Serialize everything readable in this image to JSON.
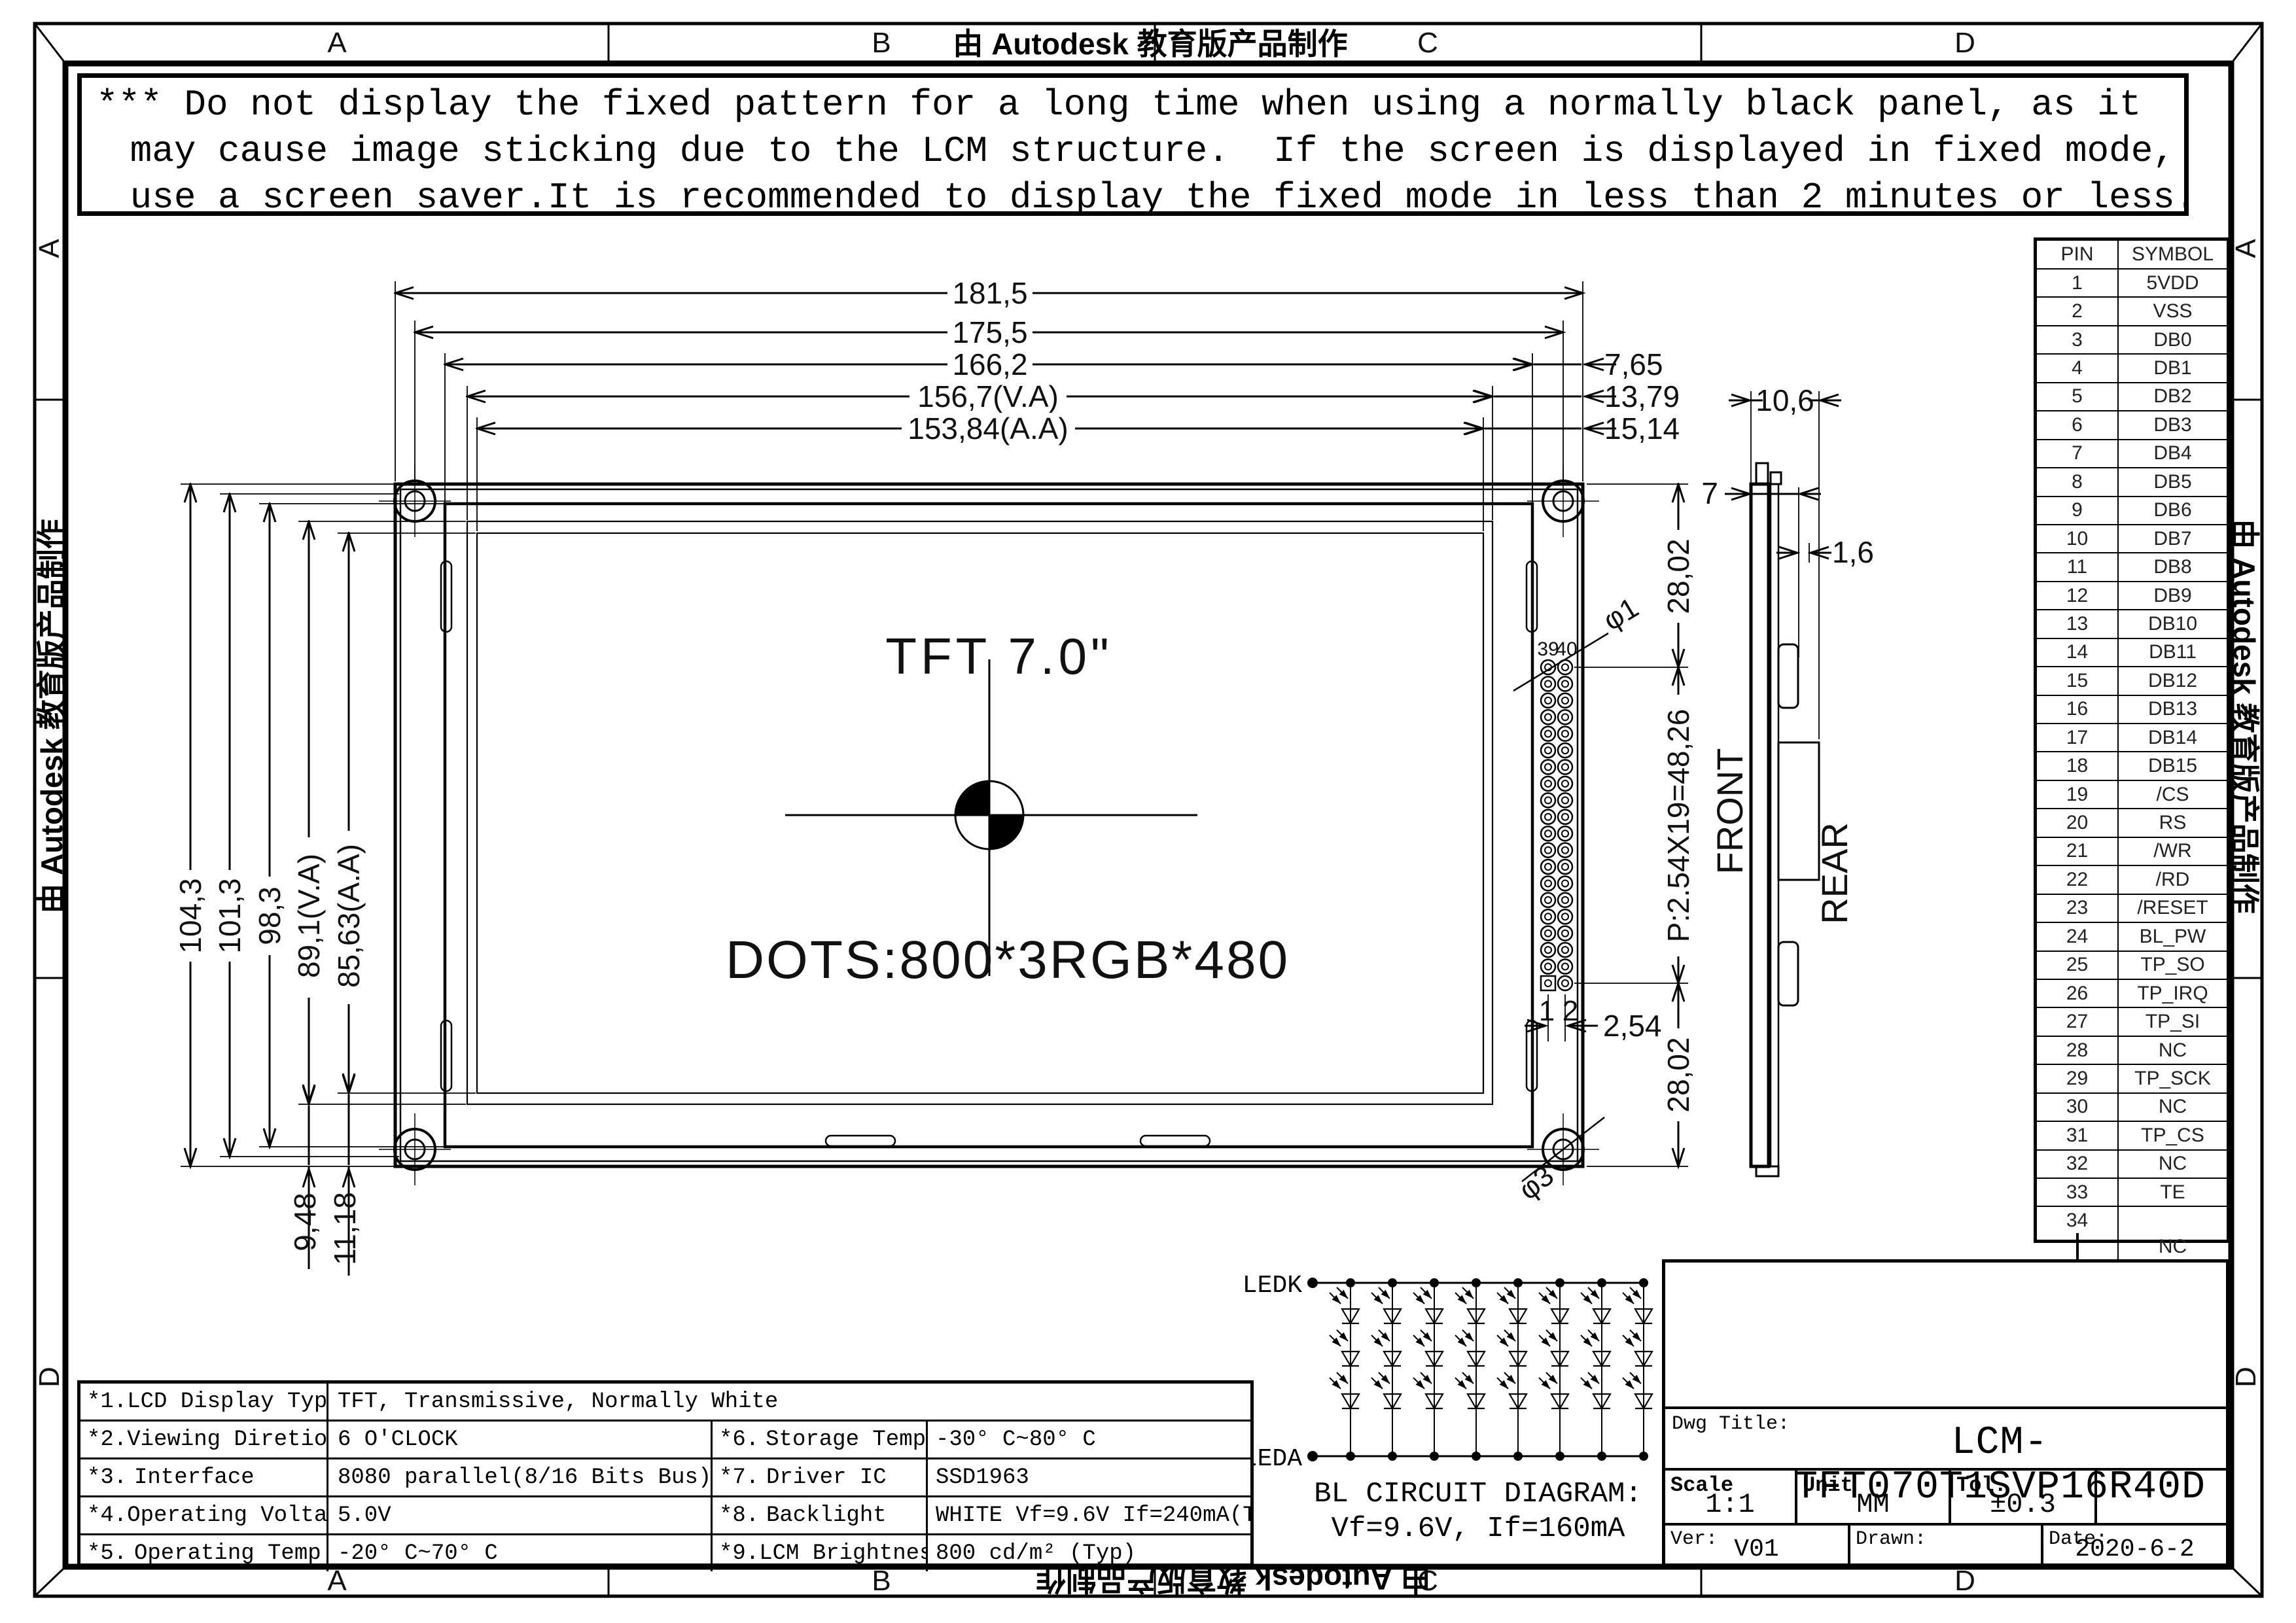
{
  "frame": {
    "watermark": "由 Autodesk 教育版产品制作",
    "zones_top": [
      "A",
      "B",
      "C",
      "D"
    ],
    "zones_bottom": [
      "A",
      "B",
      "C",
      "D"
    ],
    "zones_left": [
      "A",
      "D"
    ],
    "zones_right": [
      "A",
      "D"
    ]
  },
  "warning": {
    "line1": "*** Do not display the fixed pattern for a long time when using a normally black panel, as it",
    "line2": " may cause image sticking due to the LCM structure.  If the screen is displayed in fixed mode,",
    "line3": " use a screen saver.It is recommended to display the fixed mode in less than 2 minutes or less."
  },
  "front_view": {
    "size_label": "TFT 7.0\"",
    "dots_label": "DOTS:800*3RGB*480",
    "pin39": "39",
    "pin40": "40",
    "pin1": "1",
    "pin2": "2"
  },
  "side_view": {
    "front_label": "FRONT",
    "rear_label": "REAR"
  },
  "dims": {
    "d181": "181,5",
    "d175": "175,5",
    "d166": "166,2",
    "d156": "156,7(V.A)",
    "d153": "153,84(A.A)",
    "d765": "7,65",
    "d1379": "13,79",
    "d1514": "15,14",
    "d104": "104,3",
    "d101": "101,3",
    "d98": "98,3",
    "d89": "89,1(V.A)",
    "d85": "85,63(A.A)",
    "d948": "9,48",
    "d1118": "11,18",
    "d2802a": "28,02",
    "dpitch": "P:2.54X19=48,26",
    "d2802b": "28,02",
    "d254": "2,54",
    "phi1": "φ1",
    "phi3": "φ3",
    "d106": "10,6",
    "d7": "7",
    "d16": "1,6"
  },
  "pin_table": {
    "headers": [
      "PIN",
      "SYMBOL"
    ],
    "rows": [
      [
        "1",
        "5VDD"
      ],
      [
        "2",
        "VSS"
      ],
      [
        "3",
        "DB0"
      ],
      [
        "4",
        "DB1"
      ],
      [
        "5",
        "DB2"
      ],
      [
        "6",
        "DB3"
      ],
      [
        "7",
        "DB4"
      ],
      [
        "8",
        "DB5"
      ],
      [
        "9",
        "DB6"
      ],
      [
        "10",
        "DB7"
      ],
      [
        "11",
        "DB8"
      ],
      [
        "12",
        "DB9"
      ],
      [
        "13",
        "DB10"
      ],
      [
        "14",
        "DB11"
      ],
      [
        "15",
        "DB12"
      ],
      [
        "16",
        "DB13"
      ],
      [
        "17",
        "DB14"
      ],
      [
        "18",
        "DB15"
      ],
      [
        "19",
        "/CS"
      ],
      [
        "20",
        "RS"
      ],
      [
        "21",
        "/WR"
      ],
      [
        "22",
        "/RD"
      ],
      [
        "23",
        "/RESET"
      ],
      [
        "24",
        "BL_PW"
      ],
      [
        "25",
        "TP_SO"
      ],
      [
        "26",
        "TP_IRQ"
      ],
      [
        "27",
        "TP_SI"
      ],
      [
        "28",
        "NC"
      ],
      [
        "29",
        "TP_SCK"
      ],
      [
        "30",
        "NC"
      ],
      [
        "31",
        "TP_CS"
      ],
      [
        "32",
        "NC"
      ],
      [
        "33",
        "TE"
      ]
    ],
    "merged_row": {
      "from": "34",
      "to": "40",
      "symbol": "NC"
    }
  },
  "spec_table": {
    "rows": [
      {
        "num": "*1.",
        "name": "LCD Display Type",
        "value": "TFT, Transmissive, Normally White"
      },
      {
        "num": "*2.",
        "name": "Viewing Diretion",
        "value": "6 O'CLOCK",
        "num2": "*6.",
        "name2": "Storage Temp",
        "value2": "-30° C~80° C"
      },
      {
        "num": "*3.",
        "name": "Interface",
        "value": "8080 parallel(8/16 Bits Bus)",
        "num2": "*7.",
        "name2": "Driver IC",
        "value2": "SSD1963"
      },
      {
        "num": "*4.",
        "name": "Operating Voltage",
        "value": "5.0V",
        "num2": "*8.",
        "name2": "Backlight",
        "value2": "WHITE Vf=9.6V If=240mA(Typ)"
      },
      {
        "num": "*5.",
        "name": "Operating Temp",
        "value": "-20° C~70° C",
        "num2": "*9.",
        "name2": "LCM Brightness",
        "value2": "800 cd/m² (Typ)"
      }
    ]
  },
  "bl_circuit": {
    "ledk": "LEDK",
    "leda": "LEDA",
    "title": "BL CIRCUIT DIAGRAM:",
    "subtitle": "Vf=9.6V, If=160mA"
  },
  "title_block": {
    "dwg_title_label": "Dwg Title:",
    "dwg_title": "LCM-TFT070T1SVP16R40D",
    "scale_label": "Scale",
    "scale": "1:1",
    "unit_label": "Unit",
    "unit": "MM",
    "tol_label": "Tol.",
    "tol": "±0.3",
    "ver_label": "Ver:",
    "ver": "V01",
    "drawn_label": "Drawn:",
    "drawn": "",
    "date_label": "Date:",
    "date": "2020-6-2"
  }
}
